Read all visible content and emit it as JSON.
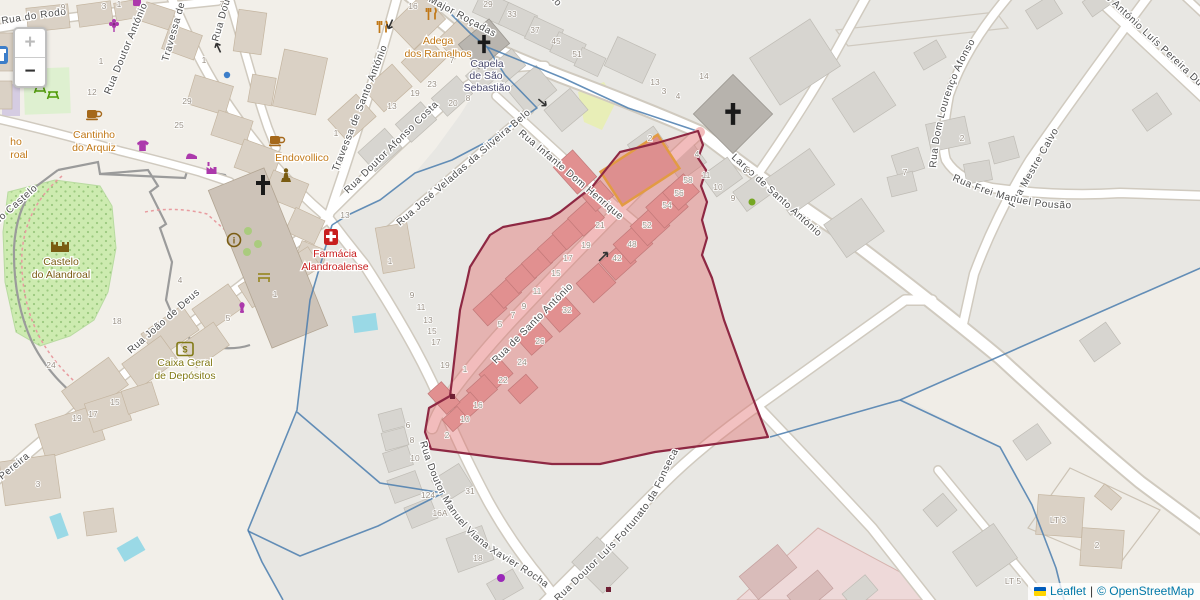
{
  "controls": {
    "zoom_in": "+",
    "zoom_out": "−"
  },
  "attribution": {
    "leaflet": "Leaflet",
    "divider": "|",
    "osm": "© OpenStreetMap"
  },
  "streets": {
    "rodo": "Rua do Rodo",
    "doutor_antonio": "Rua Doutor António",
    "travessa": "Travessa de Santo António",
    "afonso_costa": "Rua Doutor Afonso Costa",
    "jose_veladas": "Rua José Veladas da Silveira Belo",
    "infante": "Rua Infante Dom Henrique",
    "major_rocadas": "Largo Major Roçadas",
    "santo_antonio": "Rua de Santo António",
    "largo_santo_antonio": "Largo de Santo António",
    "dom_lourenco": "Rua Dom Lourenço Afonso",
    "padre_antonio": "Padre António Luís Pereira Duarte",
    "mestre_calvo": "Rua Mestre Calvo",
    "frei_manuel": "Rua Frei Manuel Pousão",
    "joao_deus": "Rua João de Deus",
    "do_castelo": "Rua do Castelo",
    "pereira": "Pereira",
    "viana_xavier": "Rua Doutor Manuel Viana Xavier Rocha",
    "fortunato": "Rua Doutor Luís Fortunato da Fonseca"
  },
  "pois": {
    "adega": {
      "l1": "Adega",
      "l2": "dos Ramalhos"
    },
    "capela": {
      "l1": "Capela",
      "l2": "de São",
      "l3": "Sebastião"
    },
    "endovollico": {
      "l1": "Endovollico"
    },
    "farmacia": {
      "l1": "Farmácia",
      "l2": "Alandroalense"
    },
    "castelo": {
      "l1": "Castelo",
      "l2": "do Alandroal"
    },
    "cantinho": {
      "l1": "Cantinho",
      "l2": "do Arquiz"
    },
    "caixa": {
      "l1": "Caixa Geral",
      "l2": "de Depósitos"
    },
    "cut": {
      "l1": "ho",
      "l2": "roal"
    }
  },
  "icons": {
    "info": "i",
    "bank": "$"
  },
  "housenums": [
    "9",
    "3",
    "1",
    "7",
    "1",
    "1",
    "12",
    "29",
    "25",
    "16",
    "29",
    "33",
    "37",
    "45",
    "51",
    "7",
    "23",
    "19",
    "13",
    "20",
    "8",
    "13",
    "14",
    "3",
    "4",
    "2",
    "4",
    "6",
    "1",
    "13",
    "1",
    "9",
    "11",
    "13",
    "15",
    "17",
    "19",
    "1",
    "58",
    "56",
    "54",
    "52",
    "48",
    "42",
    "21",
    "19",
    "17",
    "15",
    "11",
    "9",
    "7",
    "5",
    "32",
    "26",
    "24",
    "22",
    "16",
    "10",
    "2",
    "11",
    "10",
    "9",
    "2",
    "7",
    "18",
    "24",
    "4",
    "5",
    "1",
    "6",
    "8",
    "10",
    "124",
    "16A",
    "31",
    "18",
    "19",
    "17",
    "15",
    "3",
    "LT 3",
    "2",
    "LT 5"
  ],
  "colors": {
    "land_cream": "#f2efe9",
    "land_gray": "#e8e7e3",
    "red_area_fill": "#e06c6c",
    "red_area_border": "#8e2843",
    "boundary_blue": "#4a7cae",
    "water": "#aad3df",
    "park_green": "#cdebb0",
    "road_white": "#ffffff",
    "building_tan": "#dad1c5",
    "highlight_orange": "#e29b43",
    "link_blue": "#0078A8",
    "poi_orange": "#c17817",
    "poi_red": "#c81e1e",
    "poi_brown": "#7a5c12",
    "shop_purple": "#ac39ac",
    "flag_blue": "#005BBB",
    "flag_yellow": "#FFD500"
  }
}
